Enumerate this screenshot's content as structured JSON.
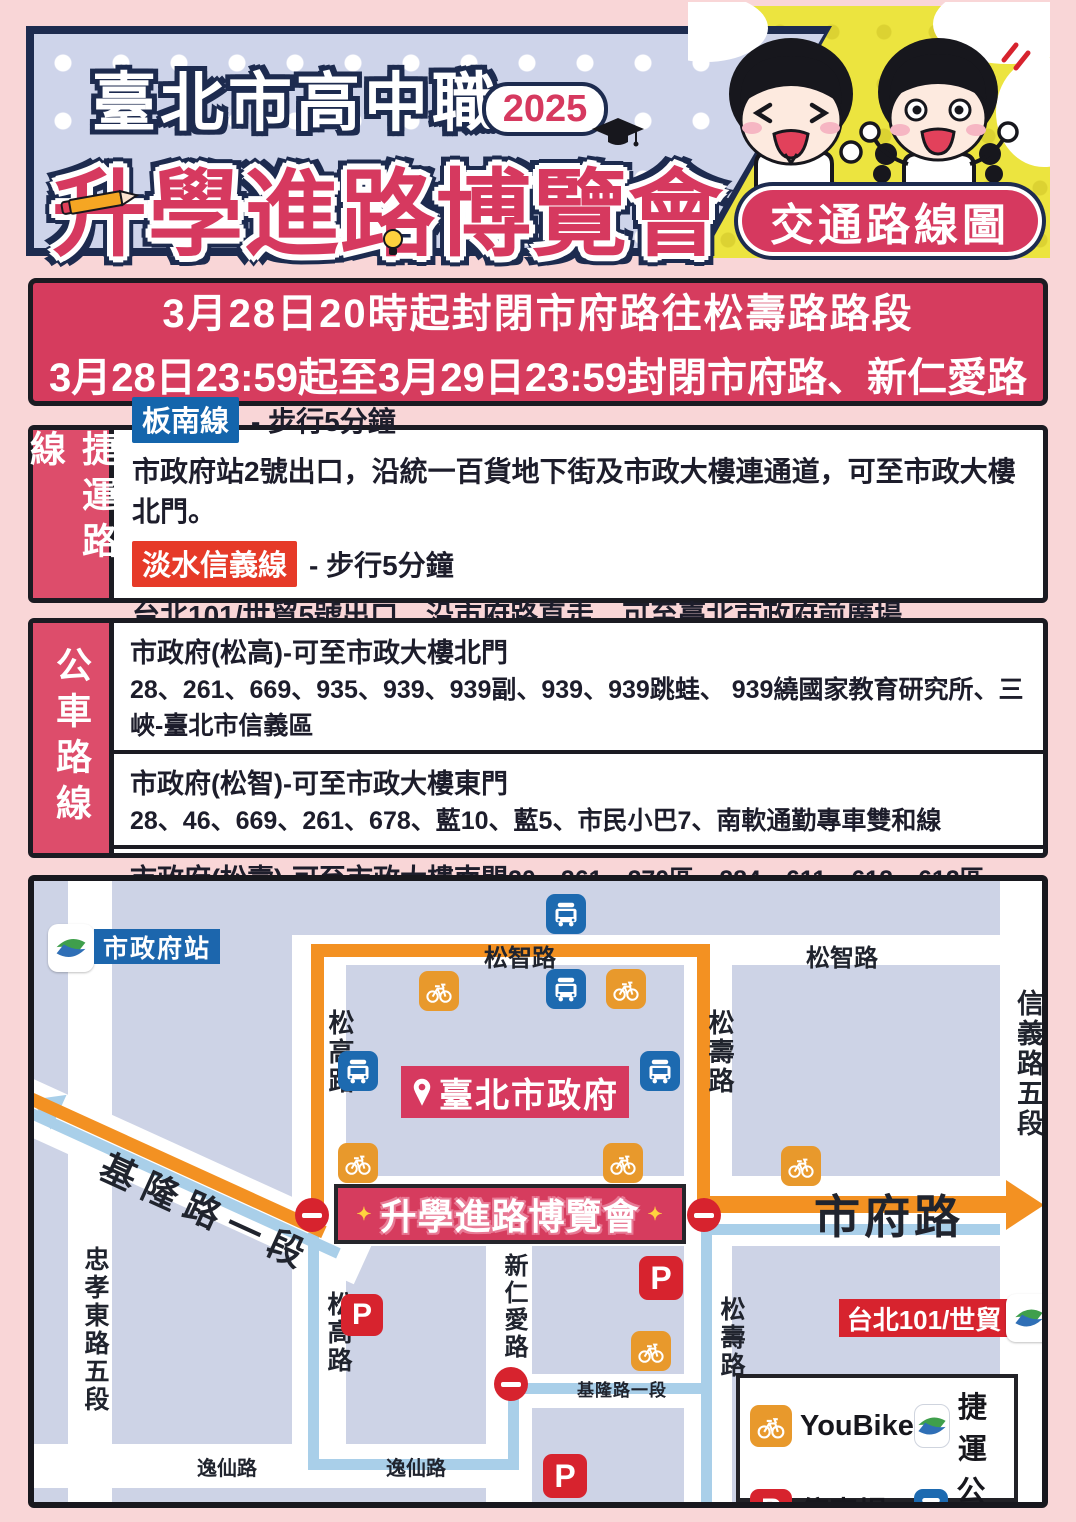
{
  "header": {
    "title_line1": "臺北市高中職",
    "year_badge": "2025",
    "title_line2": "升學進路博覽會",
    "corner_badge": "交通路線圖"
  },
  "notice": {
    "line1": "3月28日20時起封閉市府路往松壽路路段",
    "line2": "3月28日23:59起至3月29日23:59封閉市府路、新仁愛路"
  },
  "mrt": {
    "section_label": "捷運路線",
    "lines": [
      {
        "badge": "板南線",
        "walk": "- 步行5分鐘",
        "desc": "市政府站2號出口，沿統一百貨地下街及市政大樓連通道，可至市政大樓北門。"
      },
      {
        "badge": "淡水信義線",
        "walk": "- 步行5分鐘",
        "desc": "台北101/世貿5號出口，沿市府路直走，可至臺北市政府前廣場。"
      }
    ]
  },
  "bus": {
    "section_label": "公車路線",
    "stops": [
      {
        "title": "市政府(松高)-可至市政大樓北門",
        "routes": "28、261、669、935、939、939副、939、939跳蛙、 939繞國家教育研究所、三峽-臺北市信義區"
      },
      {
        "title": "市政府(松智)-可至市政大樓東門",
        "routes": "28、46、669、261、678、藍10、藍5、市民小巴7、南軟通勤專車雙和線"
      },
      {
        "title": "市政府(松壽)-可至市政大樓南門",
        "routes": "20、261、270區、284、611、612、612區、651、621、678、935、939、939副、912、承德幹線、基隆路幹線"
      }
    ]
  },
  "map": {
    "station_badge": "市政府站",
    "roads": {
      "songzhi": "松智路",
      "songgao": "松高路",
      "songshou": "松壽路",
      "shifu": "市府路",
      "xinyi": "信義路五段",
      "zhongxiao": "忠孝東路五段",
      "keelung": "基隆路一段",
      "xinren": "新仁愛路",
      "yixian": "逸仙路"
    },
    "city_hall": "臺北市政府",
    "expo_banner": "升學進路博覽會",
    "expo_sparkle": "✦",
    "station_101": "台北101/世貿",
    "parking_glyph": "P",
    "legend": {
      "youbike": "YouBike",
      "mrt": "捷運",
      "parking": "停車場",
      "bus": "公車"
    },
    "icons": [
      "youbike-icon",
      "bus-icon",
      "parking-icon",
      "mrt-logo-icon",
      "no-entry-icon",
      "location-pin-icon"
    ],
    "colors": {
      "route_orange": "#f39122",
      "route_blue": "#a9cfe9",
      "crimson": "#d6395f",
      "bus_blue": "#1d6ab0",
      "youbike_orange": "#e8992c",
      "parking_red": "#d7232e",
      "map_bg": "#cdd3e6"
    }
  }
}
